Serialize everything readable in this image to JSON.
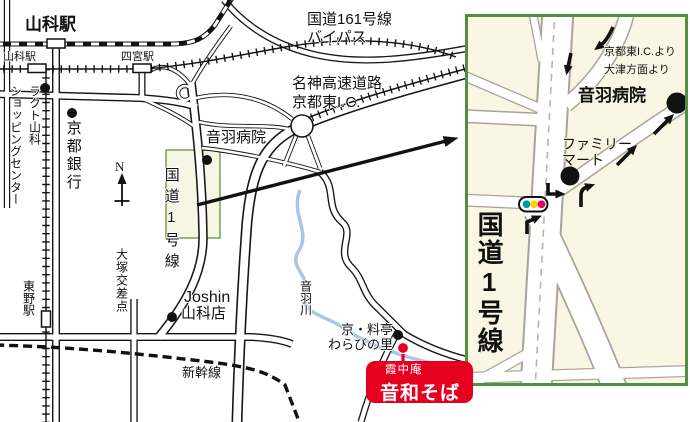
{
  "main_map": {
    "station_yamashina_jr": "山科駅",
    "station_yamashina_keihan": "山科駅",
    "station_shinomiya": "四宮駅",
    "station_higashino": "東野駅",
    "rakuto_line1": "ラクト山科",
    "rakuto_line2": "ショッピングセンター",
    "kyoto_bank": "京都銀行",
    "route161_line1": "国道161号線",
    "route161_line2": "バイパス",
    "meishin_line1": "名神高速道路",
    "meishin_line2": "京都東I.C.",
    "otowa_hospital": "音羽病院",
    "route1": "国道1号線",
    "otsuka_crossing": "大塚交差点",
    "joshin_line1": "Joshin",
    "joshin_line2": "山科店",
    "shinkansen": "新幹線",
    "otowa_river": "音羽川",
    "warabi_line1": "京・料亭",
    "warabi_line2": "わらびの里",
    "compass_n": "N"
  },
  "callout": {
    "line1": "霞中庵",
    "line2": "音和そば"
  },
  "inset": {
    "from_ic": "京都東I.C.より",
    "from_otsu": "大津方面より",
    "otowa_hospital": "音羽病院",
    "familymart_line1": "ファミリー",
    "familymart_line2": "マート",
    "route1": "国道1号線",
    "traffic_light_colors": [
      "#0097a0",
      "#ffd400",
      "#e5005a"
    ]
  },
  "colors": {
    "destination_red": "#e60020",
    "inset_border_green": "#4f9140",
    "inset_background": "#faf6e3",
    "highlight_fill": "#f7f5e4",
    "highlight_border": "#7ea55e",
    "river_blue": "#a9c6e8",
    "inset_road_casing": "#a8a49c"
  }
}
